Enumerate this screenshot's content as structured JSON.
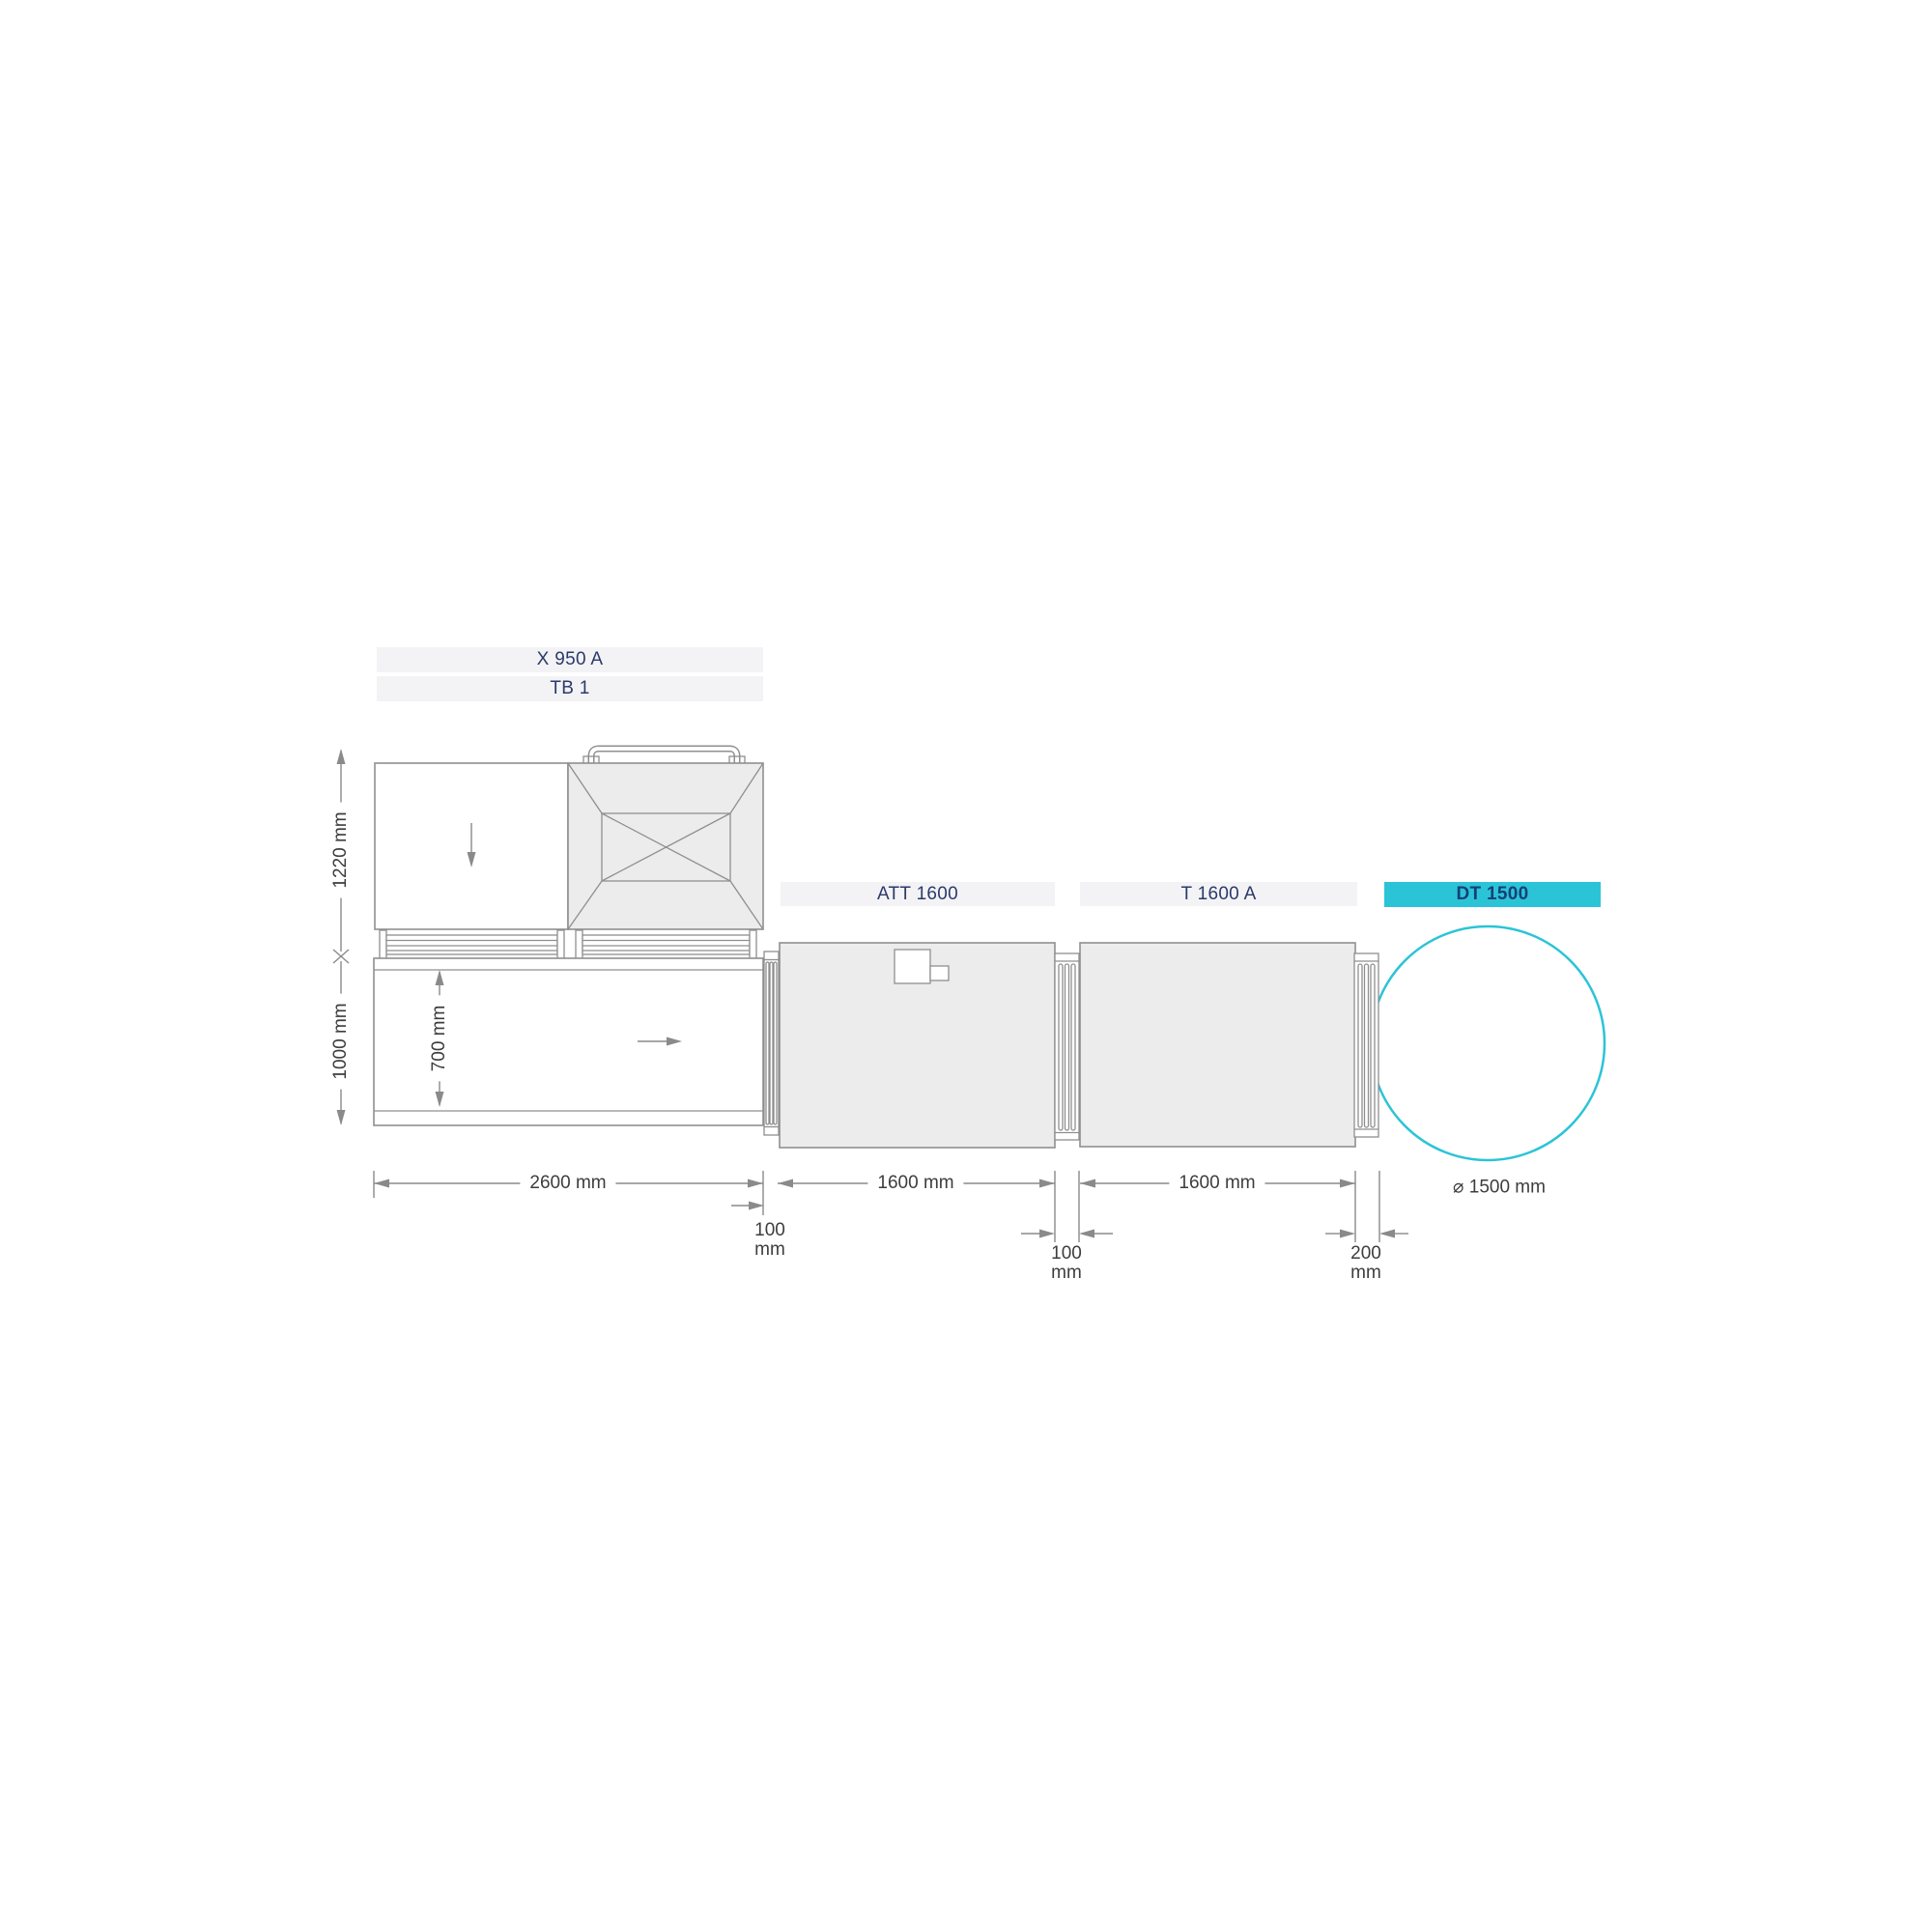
{
  "machine_labels": {
    "top_unit": "X 950 A",
    "top_unit_2": "TB 1",
    "att": "ATT 1600",
    "t": "T 1600 A",
    "dt": "DT 1500"
  },
  "dimensions": {
    "top_height": "1220 mm",
    "bottom_height": "1000 mm",
    "belt_width": "700 mm",
    "table_length": "2600 mm",
    "att_length": "1600 mm",
    "t_length": "1600 mm",
    "gap_table_att": [
      "100",
      "mm"
    ],
    "gap_att_t": [
      "100",
      "mm"
    ],
    "gap_t_dt": [
      "200",
      "mm"
    ],
    "dt_diameter": "⌀ 1500 mm"
  },
  "colors": {
    "accent_cyan": "#2bc4d6",
    "label_navy": "#2b3a6b",
    "line_gray": "#8a8a8a",
    "machine_fill": "#ececec",
    "label_bar_fill": "#f3f3f5"
  }
}
